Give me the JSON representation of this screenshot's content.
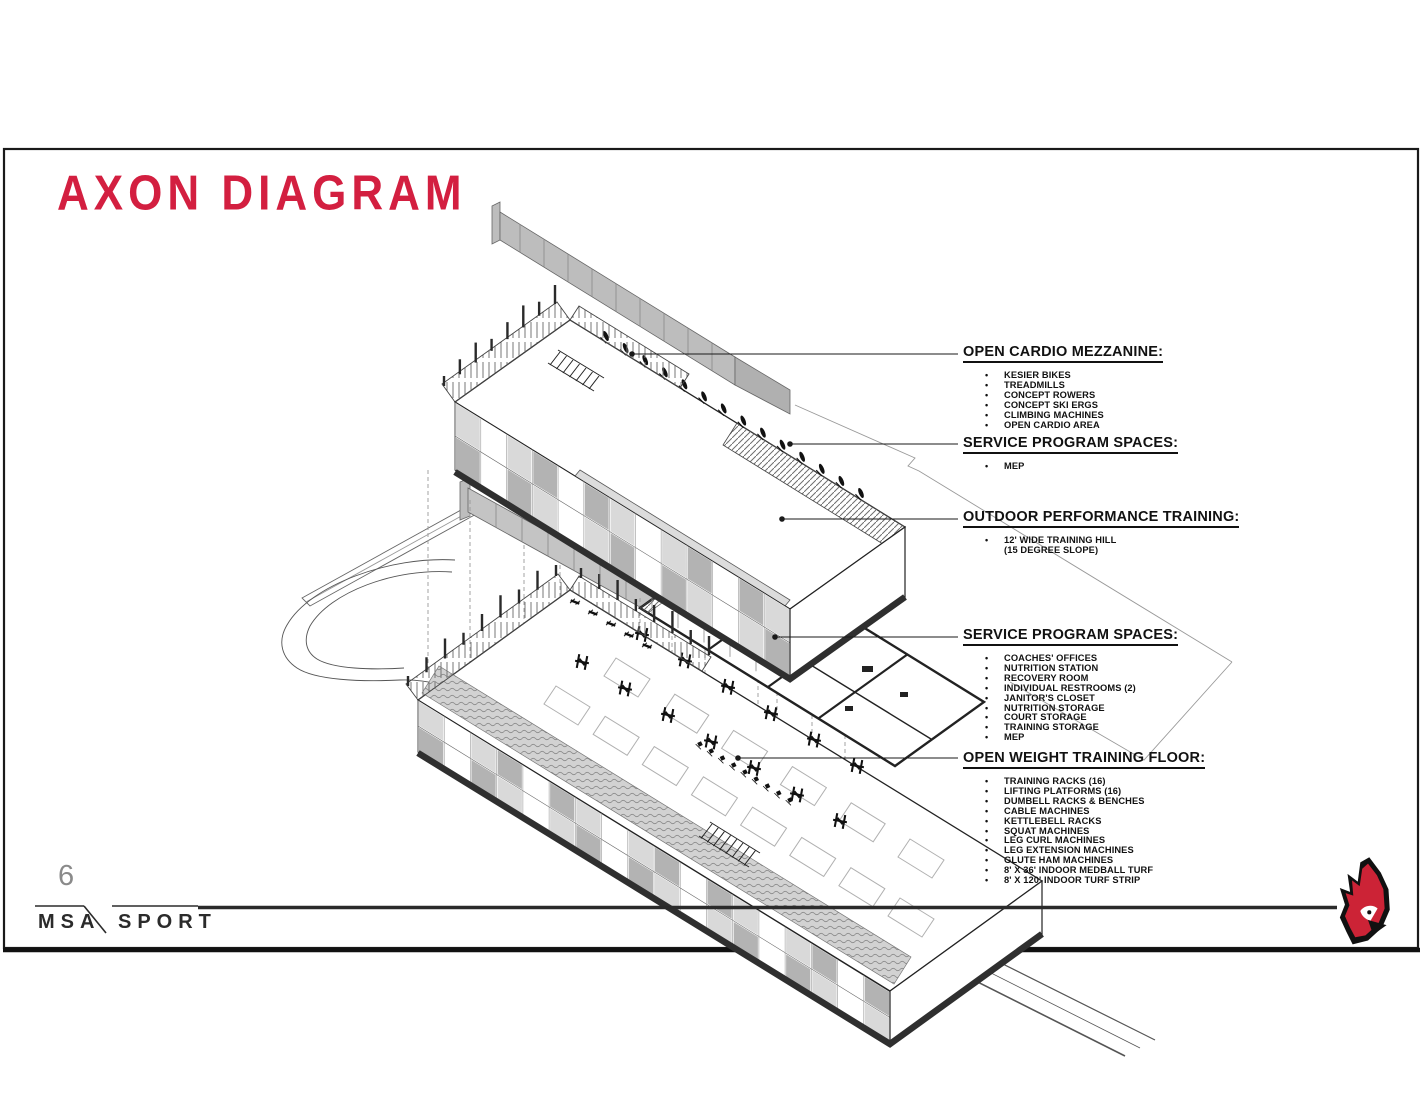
{
  "slide": {
    "title": "AXON DIAGRAM",
    "page_number": "6",
    "bullet_char": "•",
    "footer": {
      "brand_left": "MSA",
      "brand_right": "SPORT"
    },
    "colors": {
      "accent_red": "#d31f40",
      "logo_red": "#cc2336",
      "line_dark": "#1a1a1a",
      "drawing_gray": "#bdbdbd",
      "page_number_gray": "#8a8a8a"
    },
    "logo_icon": "cardinal-logo"
  },
  "callouts": [
    {
      "id": "open-cardio-mezzanine",
      "title": "OPEN CARDIO MEZZANINE:",
      "items": [
        {
          "text": "KESIER BIKES"
        },
        {
          "text": "TREADMILLS"
        },
        {
          "text": "CONCEPT ROWERS"
        },
        {
          "text": "CONCEPT SKI ERGS"
        },
        {
          "text": "CLIMBING MACHINES"
        },
        {
          "text": "OPEN CARDIO AREA"
        }
      ]
    },
    {
      "id": "service-program-spaces-upper",
      "title": "SERVICE PROGRAM SPACES:",
      "items": [
        {
          "text": "MEP"
        }
      ]
    },
    {
      "id": "outdoor-performance-training",
      "title": "OUTDOOR PERFORMANCE TRAINING:",
      "items": [
        {
          "text": "12' WIDE TRAINING HILL"
        },
        {
          "text": "(15 DEGREE SLOPE)",
          "cont": true
        }
      ]
    },
    {
      "id": "service-program-spaces-lower",
      "title": "SERVICE PROGRAM SPACES:",
      "items": [
        {
          "text": "COACHES' OFFICES"
        },
        {
          "text": "NUTRITION STATION"
        },
        {
          "text": "RECOVERY ROOM"
        },
        {
          "text": "INDIVIDUAL RESTROOMS (2)"
        },
        {
          "text": "JANITOR'S CLOSET"
        },
        {
          "text": "NUTRITION STORAGE"
        },
        {
          "text": "COURT STORAGE"
        },
        {
          "text": "TRAINING STORAGE"
        },
        {
          "text": "MEP"
        }
      ]
    },
    {
      "id": "open-weight-training-floor",
      "title": "OPEN WEIGHT TRAINING FLOOR:",
      "items": [
        {
          "text": "TRAINING RACKS (16)"
        },
        {
          "text": "LIFTING PLATFORMS (16)"
        },
        {
          "text": "DUMBELL RACKS & BENCHES"
        },
        {
          "text": "CABLE MACHINES"
        },
        {
          "text": "KETTLEBELL RACKS"
        },
        {
          "text": "SQUAT MACHINES"
        },
        {
          "text": "LEG CURL MACHINES"
        },
        {
          "text": "LEG EXTENSION MACHINES"
        },
        {
          "text": "GLUTE HAM MACHINES"
        },
        {
          "text": "8' X 36' INDOOR MEDBALL TURF"
        },
        {
          "text": "8' X 120' INDOOR TURF STRIP"
        }
      ]
    }
  ]
}
